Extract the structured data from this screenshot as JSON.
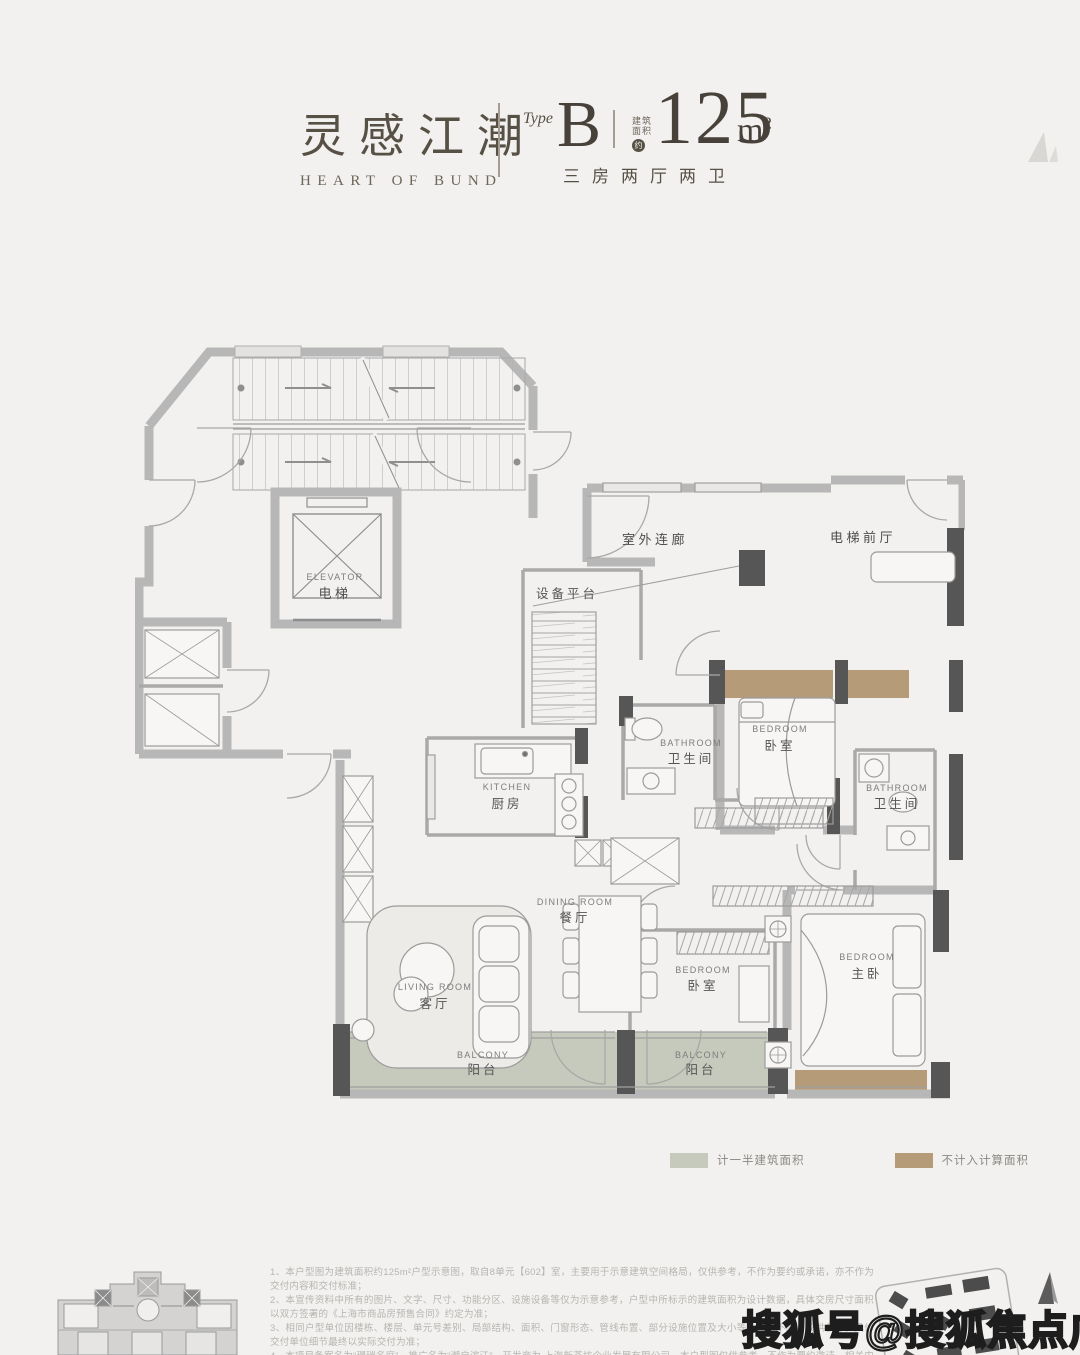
{
  "header": {
    "title_cn": "灵感江潮",
    "title_en": "HEART OF BUND",
    "type_label": "Type",
    "type_value": "B",
    "area_label_line1": "建筑",
    "area_label_line2": "面积",
    "area_approx": "约",
    "area_value": "125",
    "area_unit_base": "m",
    "area_unit_sup": "2",
    "layout_desc": "三房两厅两卫"
  },
  "floorplan": {
    "labels": {
      "elevator_en": "ELEVATOR",
      "elevator_cn": "电梯",
      "outdoor_corridor": "室外连廊",
      "elevator_lobby": "电梯前厅",
      "equipment_platform": "设备平台",
      "kitchen_en": "KITCHEN",
      "kitchen_cn": "厨房",
      "bathroom_en": "BATHROOM",
      "bathroom_cn": "卫生间",
      "bedroom_en": "BEDROOM",
      "bedroom_cn": "卧室",
      "master_bedroom_cn": "主卧",
      "dining_en": "DINING ROOM",
      "dining_cn": "餐厅",
      "living_en": "LIVING ROOM",
      "living_cn": "客厅",
      "balcony_en": "BALCONY",
      "balcony_cn": "阳台"
    },
    "legend": [
      {
        "label": "计一半建筑面积",
        "color": "#c6cabc"
      },
      {
        "label": "不计入计算面积",
        "color": "#b69b78"
      }
    ]
  },
  "footer": {
    "disclaimers": [
      "1、本户型图为建筑面积约125m²户型示意图，取自8单元【602】室，主要用于示意建筑空间格局，仅供参考，不作为要约或承诺，亦不作为交付内容和交付标准；",
      "2、本宣传资料中所有的图片、文字、尺寸、功能分区、设施设备等仅为示意参考，户型中所标示的建筑面积为设计数据，具体交房尺寸面积以双方签署的《上海市商品房预售合同》约定为准；",
      "3、相同户型单位因楼栋、楼层、单元号差别、局部结构、面积、门窗形态、管线布置、部分设施位置及大小等会有所不同，仅供参考，具体交付单位细节最终以实际交付为准；",
      "4、本项目备案名为“璟瑞名庭”，推广名为“潮启滨江”，开发商为 上海新荟坊企业发展有限公司，本户型图仅供参考，不作为要约邀请，相关内容不排除因政府相关规划、规定及开发商未能控制的原因而发生变化，本公司保留对宣传资料修改的权利，敬请留意最新资料，本户型图制作时间为2025年10月。"
    ]
  },
  "watermark": "搜狐号@搜狐焦点广安站"
}
